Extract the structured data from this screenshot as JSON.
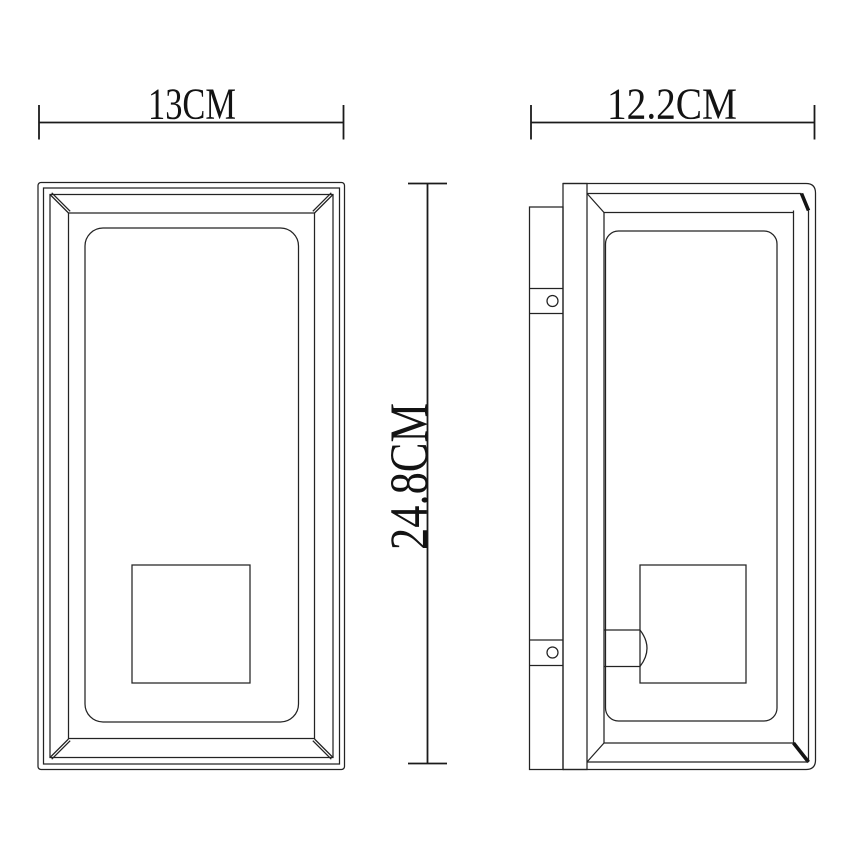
{
  "colors": {
    "background": "#ffffff",
    "line": "#232323",
    "text": "#131313"
  },
  "dimensions": {
    "front_width_label": "13CM",
    "side_depth_label": "12.2CM",
    "height_label": "24.8CM"
  }
}
